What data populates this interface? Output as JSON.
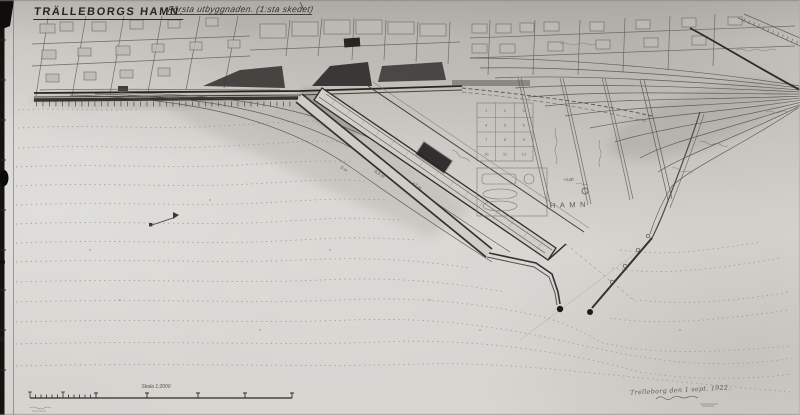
{
  "header": {
    "title": "TRÄLLEBORGS HAMN.",
    "subtitle": "Första utbyggnaden. (1:sta skedet)"
  },
  "map": {
    "area_label": "HAMN",
    "depth_marks": [
      {
        "text": "5 m"
      },
      {
        "text": "6,5 m"
      },
      {
        "text": "+7 m"
      },
      {
        "text": "+4,00"
      }
    ],
    "lot_numbers": [
      "1",
      "2",
      "3",
      "4",
      "5",
      "6",
      "7",
      "8",
      "9",
      "10",
      "11",
      "12"
    ],
    "scale_label": "Skala 1:2000",
    "date_note": "Trelleborg den 1 sept. 1922."
  },
  "colors": {
    "paper": "#d4d2cd",
    "ink": "#2e2c28",
    "pencil": "#6f6c66",
    "dark_fill": "#232220"
  }
}
